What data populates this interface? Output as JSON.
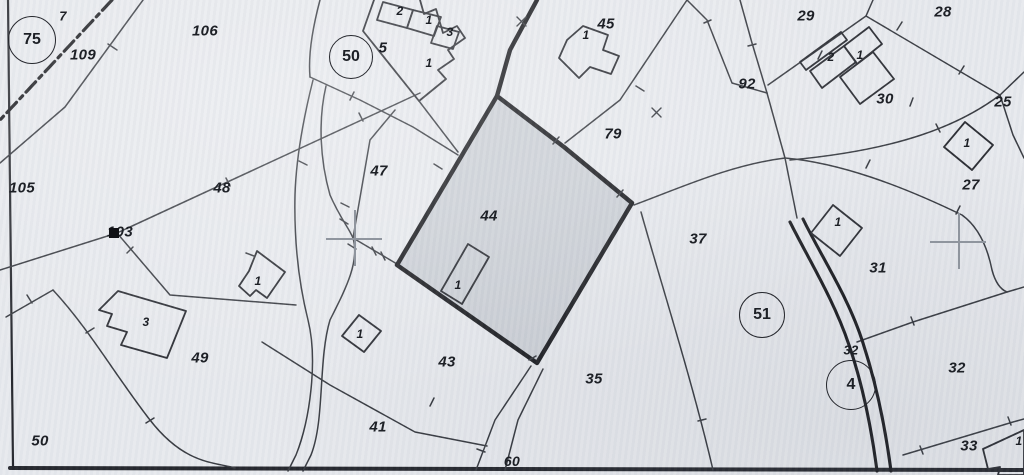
{
  "map": {
    "colors": {
      "paper": "#e7e9ed",
      "ink_thin": "#33363c",
      "ink_thick": "#17181c",
      "highlight_parcel_fill": "#c8ccd3",
      "survey_cross": "#8f959e",
      "label": "#1d2026"
    },
    "highlighted_parcel": "44",
    "parcel_labels": [
      {
        "text": "7",
        "x": 63,
        "y": 16,
        "s": 13
      },
      {
        "text": "109",
        "x": 83,
        "y": 55,
        "s": 15
      },
      {
        "text": "106",
        "x": 205,
        "y": 31,
        "s": 15
      },
      {
        "text": "105",
        "x": 22,
        "y": 188,
        "s": 15
      },
      {
        "text": "48",
        "x": 222,
        "y": 188,
        "s": 15
      },
      {
        "text": "103",
        "x": 120,
        "y": 232,
        "s": 15
      },
      {
        "text": "49",
        "x": 200,
        "y": 358,
        "s": 15
      },
      {
        "text": "50",
        "x": 40,
        "y": 441,
        "s": 15
      },
      {
        "text": "5",
        "x": 383,
        "y": 48,
        "s": 15
      },
      {
        "text": "47",
        "x": 379,
        "y": 171,
        "s": 15
      },
      {
        "text": "44",
        "x": 489,
        "y": 216,
        "s": 15
      },
      {
        "text": "43",
        "x": 447,
        "y": 362,
        "s": 15
      },
      {
        "text": "41",
        "x": 378,
        "y": 427,
        "s": 15
      },
      {
        "text": "45",
        "x": 606,
        "y": 24,
        "s": 15
      },
      {
        "text": "79",
        "x": 613,
        "y": 134,
        "s": 15
      },
      {
        "text": "35",
        "x": 594,
        "y": 379,
        "s": 15
      },
      {
        "text": "60",
        "x": 512,
        "y": 461,
        "s": 14
      },
      {
        "text": "37",
        "x": 698,
        "y": 239,
        "s": 15
      },
      {
        "text": "92",
        "x": 747,
        "y": 84,
        "s": 15
      },
      {
        "text": "29",
        "x": 806,
        "y": 16,
        "s": 15
      },
      {
        "text": "28",
        "x": 943,
        "y": 12,
        "s": 15
      },
      {
        "text": "30",
        "x": 885,
        "y": 99,
        "s": 15
      },
      {
        "text": "25",
        "x": 1003,
        "y": 102,
        "s": 15
      },
      {
        "text": "27",
        "x": 971,
        "y": 185,
        "s": 15
      },
      {
        "text": "31",
        "x": 878,
        "y": 268,
        "s": 15
      },
      {
        "text": "32",
        "x": 851,
        "y": 350,
        "s": 13
      },
      {
        "text": "32",
        "x": 957,
        "y": 368,
        "s": 15
      },
      {
        "text": "33",
        "x": 969,
        "y": 446,
        "s": 15
      }
    ],
    "building_labels": [
      {
        "text": "2",
        "x": 400,
        "y": 11
      },
      {
        "text": "1",
        "x": 429,
        "y": 20
      },
      {
        "text": "3",
        "x": 450,
        "y": 32
      },
      {
        "text": "1",
        "x": 429,
        "y": 63
      },
      {
        "text": "1",
        "x": 586,
        "y": 35
      },
      {
        "text": "1",
        "x": 458,
        "y": 285
      },
      {
        "text": "1",
        "x": 258,
        "y": 281
      },
      {
        "text": "3",
        "x": 146,
        "y": 322
      },
      {
        "text": "1",
        "x": 360,
        "y": 334
      },
      {
        "text": "2",
        "x": 831,
        "y": 57
      },
      {
        "text": "1",
        "x": 860,
        "y": 55
      },
      {
        "text": "1",
        "x": 967,
        "y": 143
      },
      {
        "text": "1",
        "x": 838,
        "y": 222
      },
      {
        "text": "1",
        "x": 1019,
        "y": 441
      }
    ],
    "region_circles": [
      {
        "label": "75",
        "x": 31,
        "y": 39,
        "r": 23
      },
      {
        "label": "50",
        "x": 350,
        "y": 56,
        "r": 21
      },
      {
        "label": "51",
        "x": 761,
        "y": 314,
        "r": 22
      },
      {
        "label": "4",
        "x": 850,
        "y": 384,
        "r": 24
      }
    ],
    "symbols": {
      "survey_crosses": [
        {
          "x": 354,
          "y": 238
        },
        {
          "x": 958,
          "y": 241
        }
      ],
      "boundary_marker_square": {
        "x": 114,
        "y": 233
      }
    }
  }
}
